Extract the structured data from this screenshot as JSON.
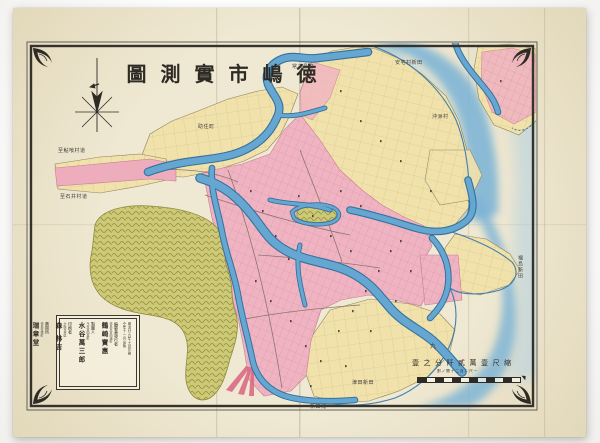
{
  "map": {
    "kind": "historical-city-map",
    "city": "徳嶋市",
    "title_reading": "徳嶋市實測圖"
  },
  "colors": {
    "paper": "#efe8d2",
    "paper_edge": "#e2d8ba",
    "frame": "#35322c",
    "ink": "#2e2b26",
    "urban_pink": "#f0b3c2",
    "urban_pink_line": "#c67f95",
    "field_yellow": "#f1e2ab",
    "field_line": "#b2a269",
    "water": "#5f9fcb",
    "water_dark": "#35719e",
    "sea": "#7fb4d8",
    "hill_green": "#cdc976",
    "hill_dark": "#8e8c3f",
    "accent_red": "#d96a84",
    "label": "#45403a"
  },
  "title": {
    "chars": [
      "圖",
      "測",
      "實",
      "市",
      "嶋",
      "徳"
    ]
  },
  "colophon": {
    "dates": {
      "printed": "明治廿九年十月印刷",
      "published": "仝年十一月出版"
    },
    "entries": [
      {
        "role": "編纂兼發行者",
        "place": "德島市富田浦町",
        "name": "鶴崎實惠"
      },
      {
        "role": "製圖人",
        "place": "今市富田裏町",
        "name": "水谷萬三郎"
      },
      {
        "role": "印刷者",
        "place": "大阪市東區",
        "name": "森 林吉"
      },
      {
        "role": "賣捌所",
        "place": "德島市幟町",
        "name": "瑞章堂"
      }
    ]
  },
  "scale": {
    "chars": [
      "壹",
      "之",
      "分",
      "阡",
      "貳",
      "萬",
      "壹",
      "尺",
      "縮"
    ],
    "reading": "縮尺壹萬貳阡分之壹",
    "sub": "割ノ間十二百ニ尺一"
  },
  "labels": [
    {
      "text": "至鮎喰村道"
    },
    {
      "text": "至石井村道"
    },
    {
      "text": "助任町"
    },
    {
      "text": "常三島町"
    },
    {
      "text": "安宅村新田"
    },
    {
      "text": "沖洲村"
    },
    {
      "text": "福島新田"
    },
    {
      "text": "津田新田"
    },
    {
      "text": "新田浦"
    },
    {
      "text": "九"
    }
  ]
}
